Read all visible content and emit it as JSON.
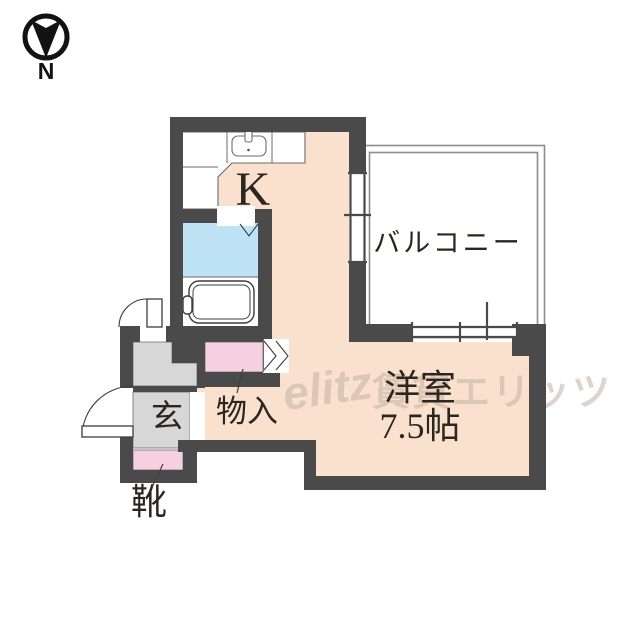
{
  "compass": {
    "label": "N"
  },
  "labels": {
    "kitchen": "K",
    "balcony": "バルコニー",
    "room_name": "洋室",
    "room_size": "7.5帖",
    "entrance": "玄",
    "storage": "物入",
    "shoes": "靴"
  },
  "watermark": {
    "logo": "elitz",
    "text": "賃貸エリッツ"
  },
  "colors": {
    "wall": "#4a4a4a",
    "floor": "#f9e1cd",
    "washroom": "#bee3f5",
    "closet": "#f6d0e0",
    "entrance": "#d7d7d7",
    "balcony_line": "#8d8d8d",
    "outline": "#6b6b6b",
    "door_line": "#3d3d3d",
    "label": "#2b2620",
    "watermark": "#c6b2a3"
  }
}
